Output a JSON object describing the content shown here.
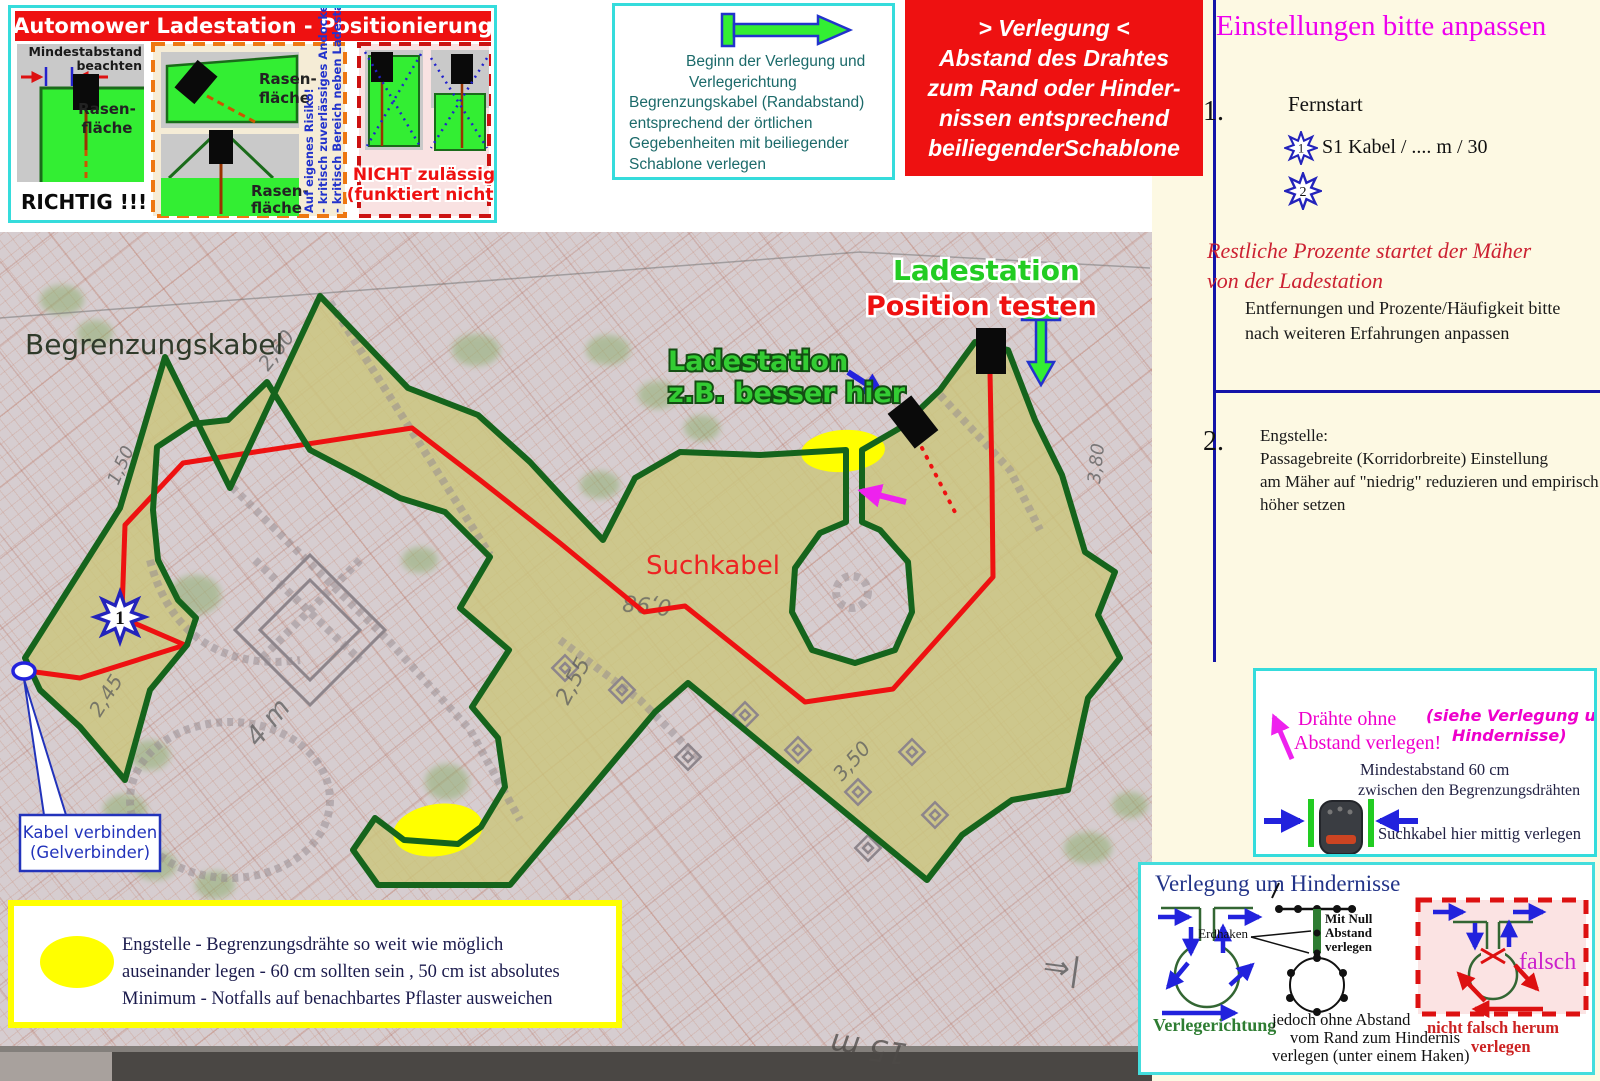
{
  "topLeftBox": {
    "title": "Automower Ladestation - Positionierung",
    "a": {
      "note1": "Mindestabstand",
      "note2": "beachten",
      "rasen1": "Rasen-",
      "rasen2": "fläche",
      "verdict": "RICHTIG !!!"
    },
    "b": {
      "rasen1": "Rasen-",
      "rasen2": "fläche",
      "rasen3": "Rasen-",
      "rasen4": "fläche",
      "risk1": "Auf eigenes Risiko!",
      "risk2": "- kritisch zuverlässiges Andocken",
      "risk3": "- kritisch Bereich neben Ladestation"
    },
    "c": {
      "bad1": "NICHT zulässig",
      "bad2": "(funktiert nicht)"
    }
  },
  "startBox": {
    "lines": [
      "Beginn der Verlegung und",
      "Verlegerichtung",
      "Begrenzungskabel (Randabstand)",
      "entsprechend der örtlichen",
      "Gegebenheiten mit beiliegender",
      "Schablone verlegen"
    ]
  },
  "redBox": {
    "lines": [
      "> Verlegung <",
      "Abstand des Drahtes",
      "zum Rand oder Hinder-",
      "nissen entsprechend",
      "beiliegenderSchablone"
    ]
  },
  "settings": {
    "title": "Einstellungen bitte anpassen",
    "item1num": "1.",
    "item1label": "Fernstart",
    "star1": "1",
    "star1text": "S1 Kabel / .... m / 30",
    "star2": "2",
    "red1": "Restliche Prozente  startet der Mäher",
    "red2": "von der Ladestation",
    "note1": "Entfernungen und Prozente/Häufigkeit bitte",
    "note2": "nach weiteren Erfahrungen anpassen",
    "item2num": "2.",
    "e1": "Engstelle:",
    "e2": "Passagebreite (Korridorbreite) Einstellung",
    "e3": "am Mäher auf \"niedrig\" reduzieren und empirisch",
    "e4": "höher setzen"
  },
  "wiresBox": {
    "m1": "Drähte ohne",
    "m2": "Abstand verlegen!",
    "s1": "(siehe Verlegung um",
    "s2": "Hindernisse)",
    "t1": "Mindestabstand 60 cm",
    "t2": "zwischen den Begrenzungsdrähten",
    "t3": "Suchkabel hier mittig verlegen"
  },
  "obstacles": {
    "title": "Verlegung um Hindernisse",
    "dir": "Verlegerichtung",
    "erdhaken": "Erdhaken",
    "null1": "Mit Null",
    "null2": "Abstand",
    "null3": "verlegen",
    "note1": "jedoch ohne Abstand",
    "note2": "vom Rand zum Hindernis",
    "note3": "verlegen (unter einem Haken)",
    "falsch": "falsch",
    "wrong1": "nicht falsch herum",
    "wrong2": "verlegen"
  },
  "map": {
    "boundaryLabel": "Begrenzungskabel",
    "stationTest1": "Ladestation",
    "stationTest2": "Position testen",
    "stationBetter1": "Ladestation",
    "stationBetter2": "z.B. besser hier",
    "searchLabel": "Suchkabel",
    "connect1": "Kabel verbinden",
    "connect2": "(Gelverbinder)",
    "star1": "1",
    "hw": [
      "2,60",
      "1,50",
      "2,45",
      "4 m",
      "2,55",
      "0,98",
      "3,50",
      "3,80",
      "15 m",
      "⇒|"
    ]
  },
  "engBox": {
    "l1": "Engstelle - Begrenzungsdrähte so weit wie möglich",
    "l2": "auseinander legen - 60 cm sollten sein , 50 cm ist absolutes",
    "l3": "Minimum - Notfalls auf benachbartes Pflaster ausweichen"
  },
  "colors": {
    "accentCyan": "#35dcdc",
    "red": "#ee1111",
    "magenta": "#ee00ee",
    "darkBlue": "#1414a8",
    "boundaryGreen": "#15641c",
    "lawn": "#cbc67c",
    "cream": "#fdf9e3",
    "highlightYellow": "#ffff00"
  }
}
